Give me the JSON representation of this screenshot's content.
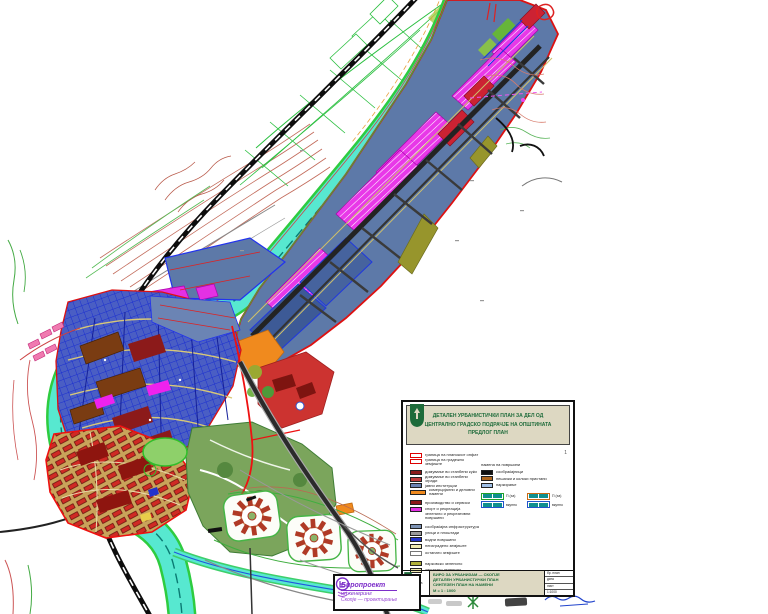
{
  "legend": {
    "mark": "1",
    "header": {
      "line1": "ДЕТАЛЕН УРБАНИСТИЧКИ ПЛАН ЗА ДЕЛ ОД",
      "line2": "ЦЕНТРАЛНО ГРАДСКО ПОДРАЧЈЕ НА ОПШТИНАТА",
      "line3": "ПРЕДЛОГ ПЛАН"
    },
    "items_left": [
      {
        "swatch": "#ffffff",
        "border": "#dd0000",
        "label": "граница на планскиот опфат"
      },
      {
        "swatch": "#ffffff",
        "border": "#dd0000",
        "label": "граница на градежно земјиште"
      },
      {
        "gap": true
      },
      {
        "swatch": "#8c1a1a",
        "label": "домување во станбени куќи"
      },
      {
        "swatch": "#c43b3b",
        "label": "домување во станбени згради"
      },
      {
        "swatch": "#6b84b4",
        "label": "јавни институции"
      },
      {
        "swatch": "#f08a1e",
        "wide": true,
        "label": "комерцијални и деловни намени"
      },
      {
        "gap": true
      },
      {
        "swatch": "#8c1a1a",
        "label": "производство и сервиси"
      },
      {
        "swatch": "#e431e4",
        "label": "спорт и рекреација"
      },
      {
        "label": "зеленило и рекреативни површини"
      },
      {
        "gap": true
      },
      {
        "swatch": "#7d93b5",
        "label": "сообраќајна инфраструктура"
      },
      {
        "swatch": "#9a9a9a",
        "label": "улици и плоштади"
      },
      {
        "swatch": "#2233cc",
        "label": "водни површини"
      },
      {
        "swatch": "#efe9b0",
        "label": "неизградено земјиште"
      },
      {
        "swatch": "#ffffff",
        "border": "#777777",
        "label": "останато земјиште"
      },
      {
        "gap": true
      },
      {
        "swatch": "#b0b03a",
        "label": "парковско зеленило"
      },
      {
        "swatch": "#efe9b0",
        "label": "заштитно зеленило"
      }
    ],
    "right_caption": "намена на површини",
    "items_right": [
      {
        "swatch": "#111111",
        "label": "сообраќајници"
      },
      {
        "swatch": "#b06820",
        "label": "пешачки и колски пристапи"
      },
      {
        "swatch": "#9fc0e8",
        "label": "паркирање"
      }
    ],
    "tables": [
      {
        "border": "#1fa32a",
        "label": "П (ха)",
        "sub_label": "вкупно"
      },
      {
        "border": "#c96a14",
        "label": "П (ха)",
        "sub_label": "вкупно"
      }
    ],
    "footer": {
      "left_caption": "заверка",
      "org1": "БИРО ЗА УРБАНИЗАМ — СКОПЈЕ",
      "org2": "ДЕТАЛЕН УРБАНИСТИЧКИ ПЛАН",
      "org3": "СИНТЕЗЕН ПЛАН НА НАМЕНИ",
      "org4": "М = 1 : 1000",
      "right_rows": [
        "бр. план",
        "дата",
        "лист",
        "1:1000"
      ]
    }
  },
  "stamp": {
    "line1": "Биропроект",
    "line2": "инженеринг",
    "line3": "Скопје — проектирање",
    "accent": "#7d2fc9"
  }
}
